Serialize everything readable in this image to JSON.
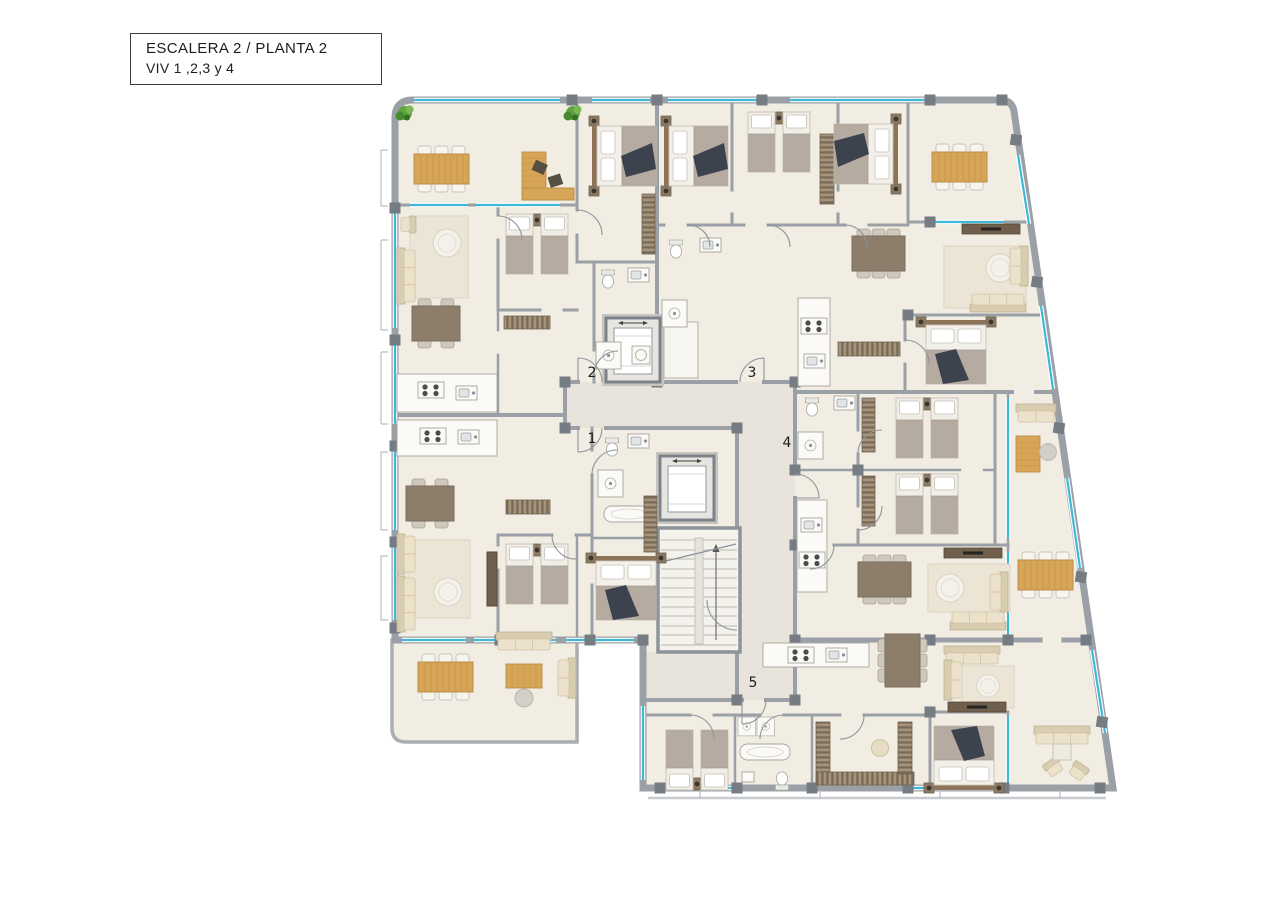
{
  "title_block": {
    "line1": "ESCALERA 2 / PLANTA 2",
    "line2": "VIV 1 ,2,3 y 4"
  },
  "floorplan": {
    "description": "Apartment building floor plan, stairwell 2 level 2, dwellings 1-4 plus unit 5 entrance",
    "unit_labels": [
      {
        "label": "1"
      },
      {
        "label": "2"
      },
      {
        "label": "3"
      },
      {
        "label": "4"
      },
      {
        "label": "5"
      }
    ]
  },
  "palette": {
    "background": "#ffffff",
    "floor": "#f1ede3",
    "corridor": "#e8e4db",
    "wall": "#9aa0a6",
    "wall_dark": "#757c83",
    "window": "#3fb8d8",
    "wood": "#d7a557",
    "table_brown": "#8d7e6c",
    "sofa": "#ece2cb",
    "rug": "#ece5d6",
    "bed_blanket": "#b5aba1",
    "bed_dark": "#3d434e",
    "wardrobe": "#a6937b",
    "wardrobe_stripe": "#776a56",
    "plant": "#5fa43f",
    "fixture": "#fbfaf7"
  }
}
